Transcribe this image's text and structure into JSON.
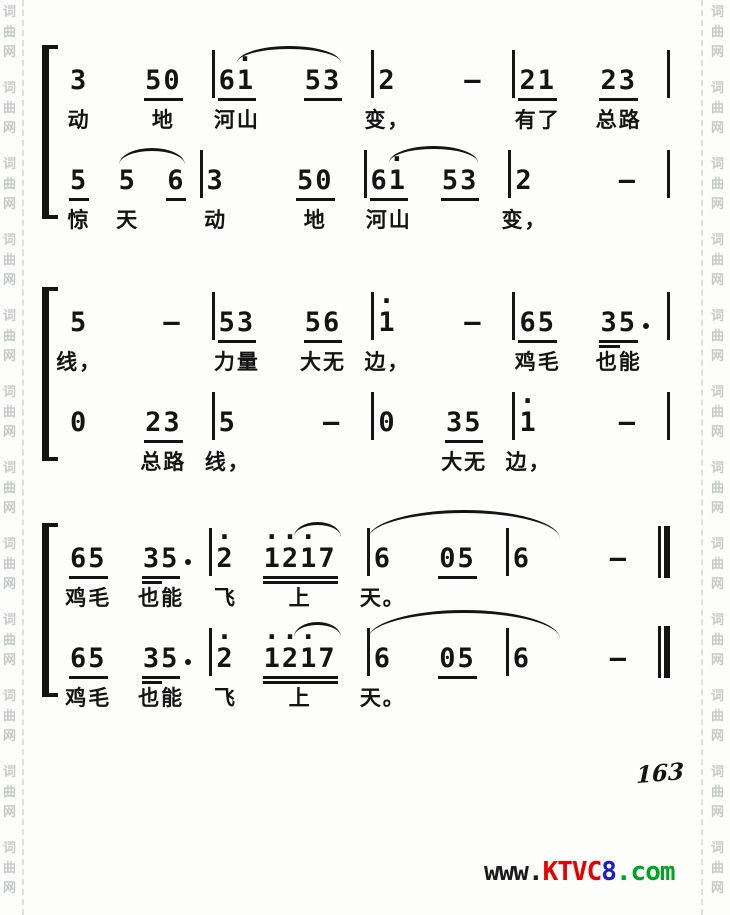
{
  "page": {
    "number": "163"
  },
  "watermark": {
    "chars": [
      "词",
      "曲",
      "网"
    ],
    "left_repeat": 12,
    "right_repeat": 12,
    "color": "#c6cbca"
  },
  "footer": {
    "url_segments": [
      {
        "text": "www.",
        "color": "#1c1c1c"
      },
      {
        "text": "KTVC",
        "color": "#e80000"
      },
      {
        "text": "8",
        "color": "#1b1bd0"
      },
      {
        "text": ".com",
        "color": "#00a322"
      }
    ]
  },
  "score": {
    "systems": [
      {
        "lines": [
          {
            "measures": [
              {
                "cells": [
                  {
                    "n": "3",
                    "lyr": "动"
                  },
                  {
                    "n": "50",
                    "u": 1,
                    "lyr": "地"
                  }
                ]
              },
              {
                "cells": [
                  {
                    "n": "61",
                    "u": 1,
                    "hi": [
                      1
                    ],
                    "lyr": "河山"
                  },
                  {
                    "n": "53",
                    "u": 1,
                    "lyr": ""
                  }
                ]
              },
              {
                "cells": [
                  {
                    "n": "2",
                    "lyr": "变，"
                  },
                  {
                    "n": "–",
                    "lyr": ""
                  }
                ]
              },
              {
                "cells": [
                  {
                    "n": "21",
                    "u": 1,
                    "lyr": "有了"
                  },
                  {
                    "n": "23",
                    "u": 1,
                    "lyr": "总路"
                  }
                ]
              }
            ],
            "end": "bar",
            "slurs": [
              {
                "f": [
                  1,
                  0
                ],
                "t": [
                  1,
                  1
                ],
                "fx": 0.5,
                "tx": 1.0,
                "top": 0,
                "h": 14
              }
            ]
          },
          {
            "measures": [
              {
                "cells": [
                  {
                    "n": "5",
                    "u": 1,
                    "lyr": "惊"
                  },
                  {
                    "n": "5",
                    "lyr": "天"
                  },
                  {
                    "n": "6",
                    "u": 1,
                    "lyr": ""
                  }
                ]
              },
              {
                "cells": [
                  {
                    "n": "3",
                    "lyr": "动"
                  },
                  {
                    "n": "50",
                    "u": 1,
                    "lyr": "地"
                  }
                ]
              },
              {
                "cells": [
                  {
                    "n": "61",
                    "u": 1,
                    "hi": [
                      1
                    ],
                    "lyr": "河山"
                  },
                  {
                    "n": "53",
                    "u": 1,
                    "lyr": ""
                  }
                ]
              },
              {
                "cells": [
                  {
                    "n": "2",
                    "lyr": "变，"
                  },
                  {
                    "n": "–",
                    "lyr": ""
                  }
                ]
              }
            ],
            "end": "bar",
            "slurs": [
              {
                "f": [
                  0,
                  1
                ],
                "t": [
                  0,
                  2
                ],
                "fx": 0.0,
                "tx": 1.0,
                "top": 2,
                "h": 14
              },
              {
                "f": [
                  2,
                  0
                ],
                "t": [
                  2,
                  1
                ],
                "fx": 0.5,
                "tx": 1.0,
                "top": 0,
                "h": 14
              }
            ]
          }
        ]
      },
      {
        "lines": [
          {
            "measures": [
              {
                "cells": [
                  {
                    "n": "5",
                    "lyr": "线，"
                  },
                  {
                    "n": "–",
                    "lyr": ""
                  }
                ]
              },
              {
                "cells": [
                  {
                    "n": "53",
                    "u": 1,
                    "lyr": "力量"
                  },
                  {
                    "n": "56",
                    "u": 1,
                    "lyr": "大无"
                  }
                ]
              },
              {
                "cells": [
                  {
                    "n": "1",
                    "hi": [
                      0
                    ],
                    "lyr": "边，"
                  },
                  {
                    "n": "–",
                    "lyr": ""
                  }
                ]
              },
              {
                "cells": [
                  {
                    "n": "65",
                    "u": 1,
                    "lyr": "鸡毛"
                  },
                  {
                    "n": "35",
                    "u": 1,
                    "u2": true,
                    "dot": true,
                    "lyr": "也能"
                  }
                ]
              }
            ],
            "end": "bar",
            "slurs": []
          },
          {
            "measures": [
              {
                "cells": [
                  {
                    "n": "0",
                    "lyr": ""
                  },
                  {
                    "n": "23",
                    "u": 1,
                    "lyr": "总路"
                  }
                ]
              },
              {
                "cells": [
                  {
                    "n": "5",
                    "lyr": "线，"
                  },
                  {
                    "n": "–",
                    "lyr": ""
                  }
                ]
              },
              {
                "cells": [
                  {
                    "n": "0",
                    "lyr": ""
                  },
                  {
                    "n": "35",
                    "u": 1,
                    "lyr": "大无"
                  }
                ]
              },
              {
                "cells": [
                  {
                    "n": "1",
                    "hi": [
                      0
                    ],
                    "lyr": "边，"
                  },
                  {
                    "n": "–",
                    "lyr": ""
                  }
                ]
              }
            ],
            "end": "bar",
            "slurs": []
          }
        ]
      },
      {
        "lines": [
          {
            "measures": [
              {
                "cells": [
                  {
                    "n": "65",
                    "u": 1,
                    "lyr": "鸡毛"
                  },
                  {
                    "n": "35",
                    "u": 1,
                    "u2": true,
                    "dot": true,
                    "lyr": "也能"
                  }
                ]
              },
              {
                "cells": [
                  {
                    "n": "2",
                    "hi": [
                      0
                    ],
                    "lyr": "飞"
                  },
                  {
                    "n": "1217",
                    "u": 2,
                    "hi": [
                      0,
                      1,
                      2
                    ],
                    "tie": true,
                    "lyr": "上"
                  }
                ]
              },
              {
                "cells": [
                  {
                    "n": "6",
                    "lyr": "天。"
                  },
                  {
                    "n": "05",
                    "u": 1,
                    "lyr": ""
                  }
                ]
              },
              {
                "cells": [
                  {
                    "n": "6",
                    "lyr": ""
                  },
                  {
                    "n": "–",
                    "lyr": ""
                  }
                ]
              }
            ],
            "end": "final",
            "slurs": [
              {
                "f": [
                  2,
                  0
                ],
                "t": [
                  3,
                  0
                ],
                "fx": -0.3,
                "tx": 2.6,
                "top": -14,
                "h": 26
              }
            ]
          },
          {
            "measures": [
              {
                "cells": [
                  {
                    "n": "65",
                    "u": 1,
                    "lyr": "鸡毛"
                  },
                  {
                    "n": "35",
                    "u": 1,
                    "u2": true,
                    "dot": true,
                    "lyr": "也能"
                  }
                ]
              },
              {
                "cells": [
                  {
                    "n": "2",
                    "hi": [
                      0
                    ],
                    "lyr": "飞"
                  },
                  {
                    "n": "1217",
                    "u": 2,
                    "hi": [
                      0,
                      1,
                      2
                    ],
                    "tie": true,
                    "lyr": "上"
                  }
                ]
              },
              {
                "cells": [
                  {
                    "n": "6",
                    "lyr": "天。"
                  },
                  {
                    "n": "05",
                    "u": 1,
                    "lyr": ""
                  }
                ]
              },
              {
                "cells": [
                  {
                    "n": "6",
                    "lyr": ""
                  },
                  {
                    "n": "–",
                    "lyr": ""
                  }
                ]
              }
            ],
            "end": "final",
            "slurs": [
              {
                "f": [
                  2,
                  0
                ],
                "t": [
                  3,
                  0
                ],
                "fx": -0.3,
                "tx": 2.6,
                "top": -14,
                "h": 26
              }
            ]
          }
        ]
      }
    ]
  }
}
